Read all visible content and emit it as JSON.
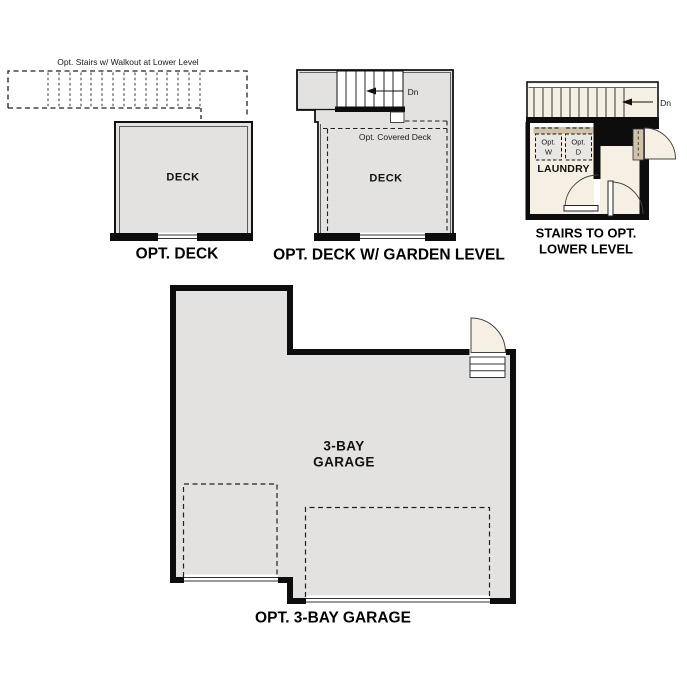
{
  "colors": {
    "wall": "#0d0d0d",
    "floor_gray": "#e3e2e0",
    "floor_cream": "#f6efe3",
    "counter_tan": "#cfc2a9",
    "appliance_fill": "#e8e7e4"
  },
  "panels": {
    "opt_deck": {
      "note": "Opt. Stairs w/ Walkout at Lower Level",
      "room_label": "DECK",
      "caption": "OPT. DECK"
    },
    "garden_level": {
      "down_label": "Dn",
      "covered_note": "Opt. Covered Deck",
      "room_label": "DECK",
      "caption": "OPT. DECK W/ GARDEN LEVEL"
    },
    "lower_level": {
      "down_label": "Dn",
      "washer_line1": "Opt.",
      "washer_line2": "W",
      "dryer_line1": "Opt.",
      "dryer_line2": "D",
      "room_label": "LAUNDRY",
      "caption_line1": "STAIRS TO OPT.",
      "caption_line2": "LOWER LEVEL"
    },
    "garage": {
      "room_label_line1": "3-BAY",
      "room_label_line2": "GARAGE",
      "caption": "OPT. 3-BAY GARAGE"
    }
  }
}
